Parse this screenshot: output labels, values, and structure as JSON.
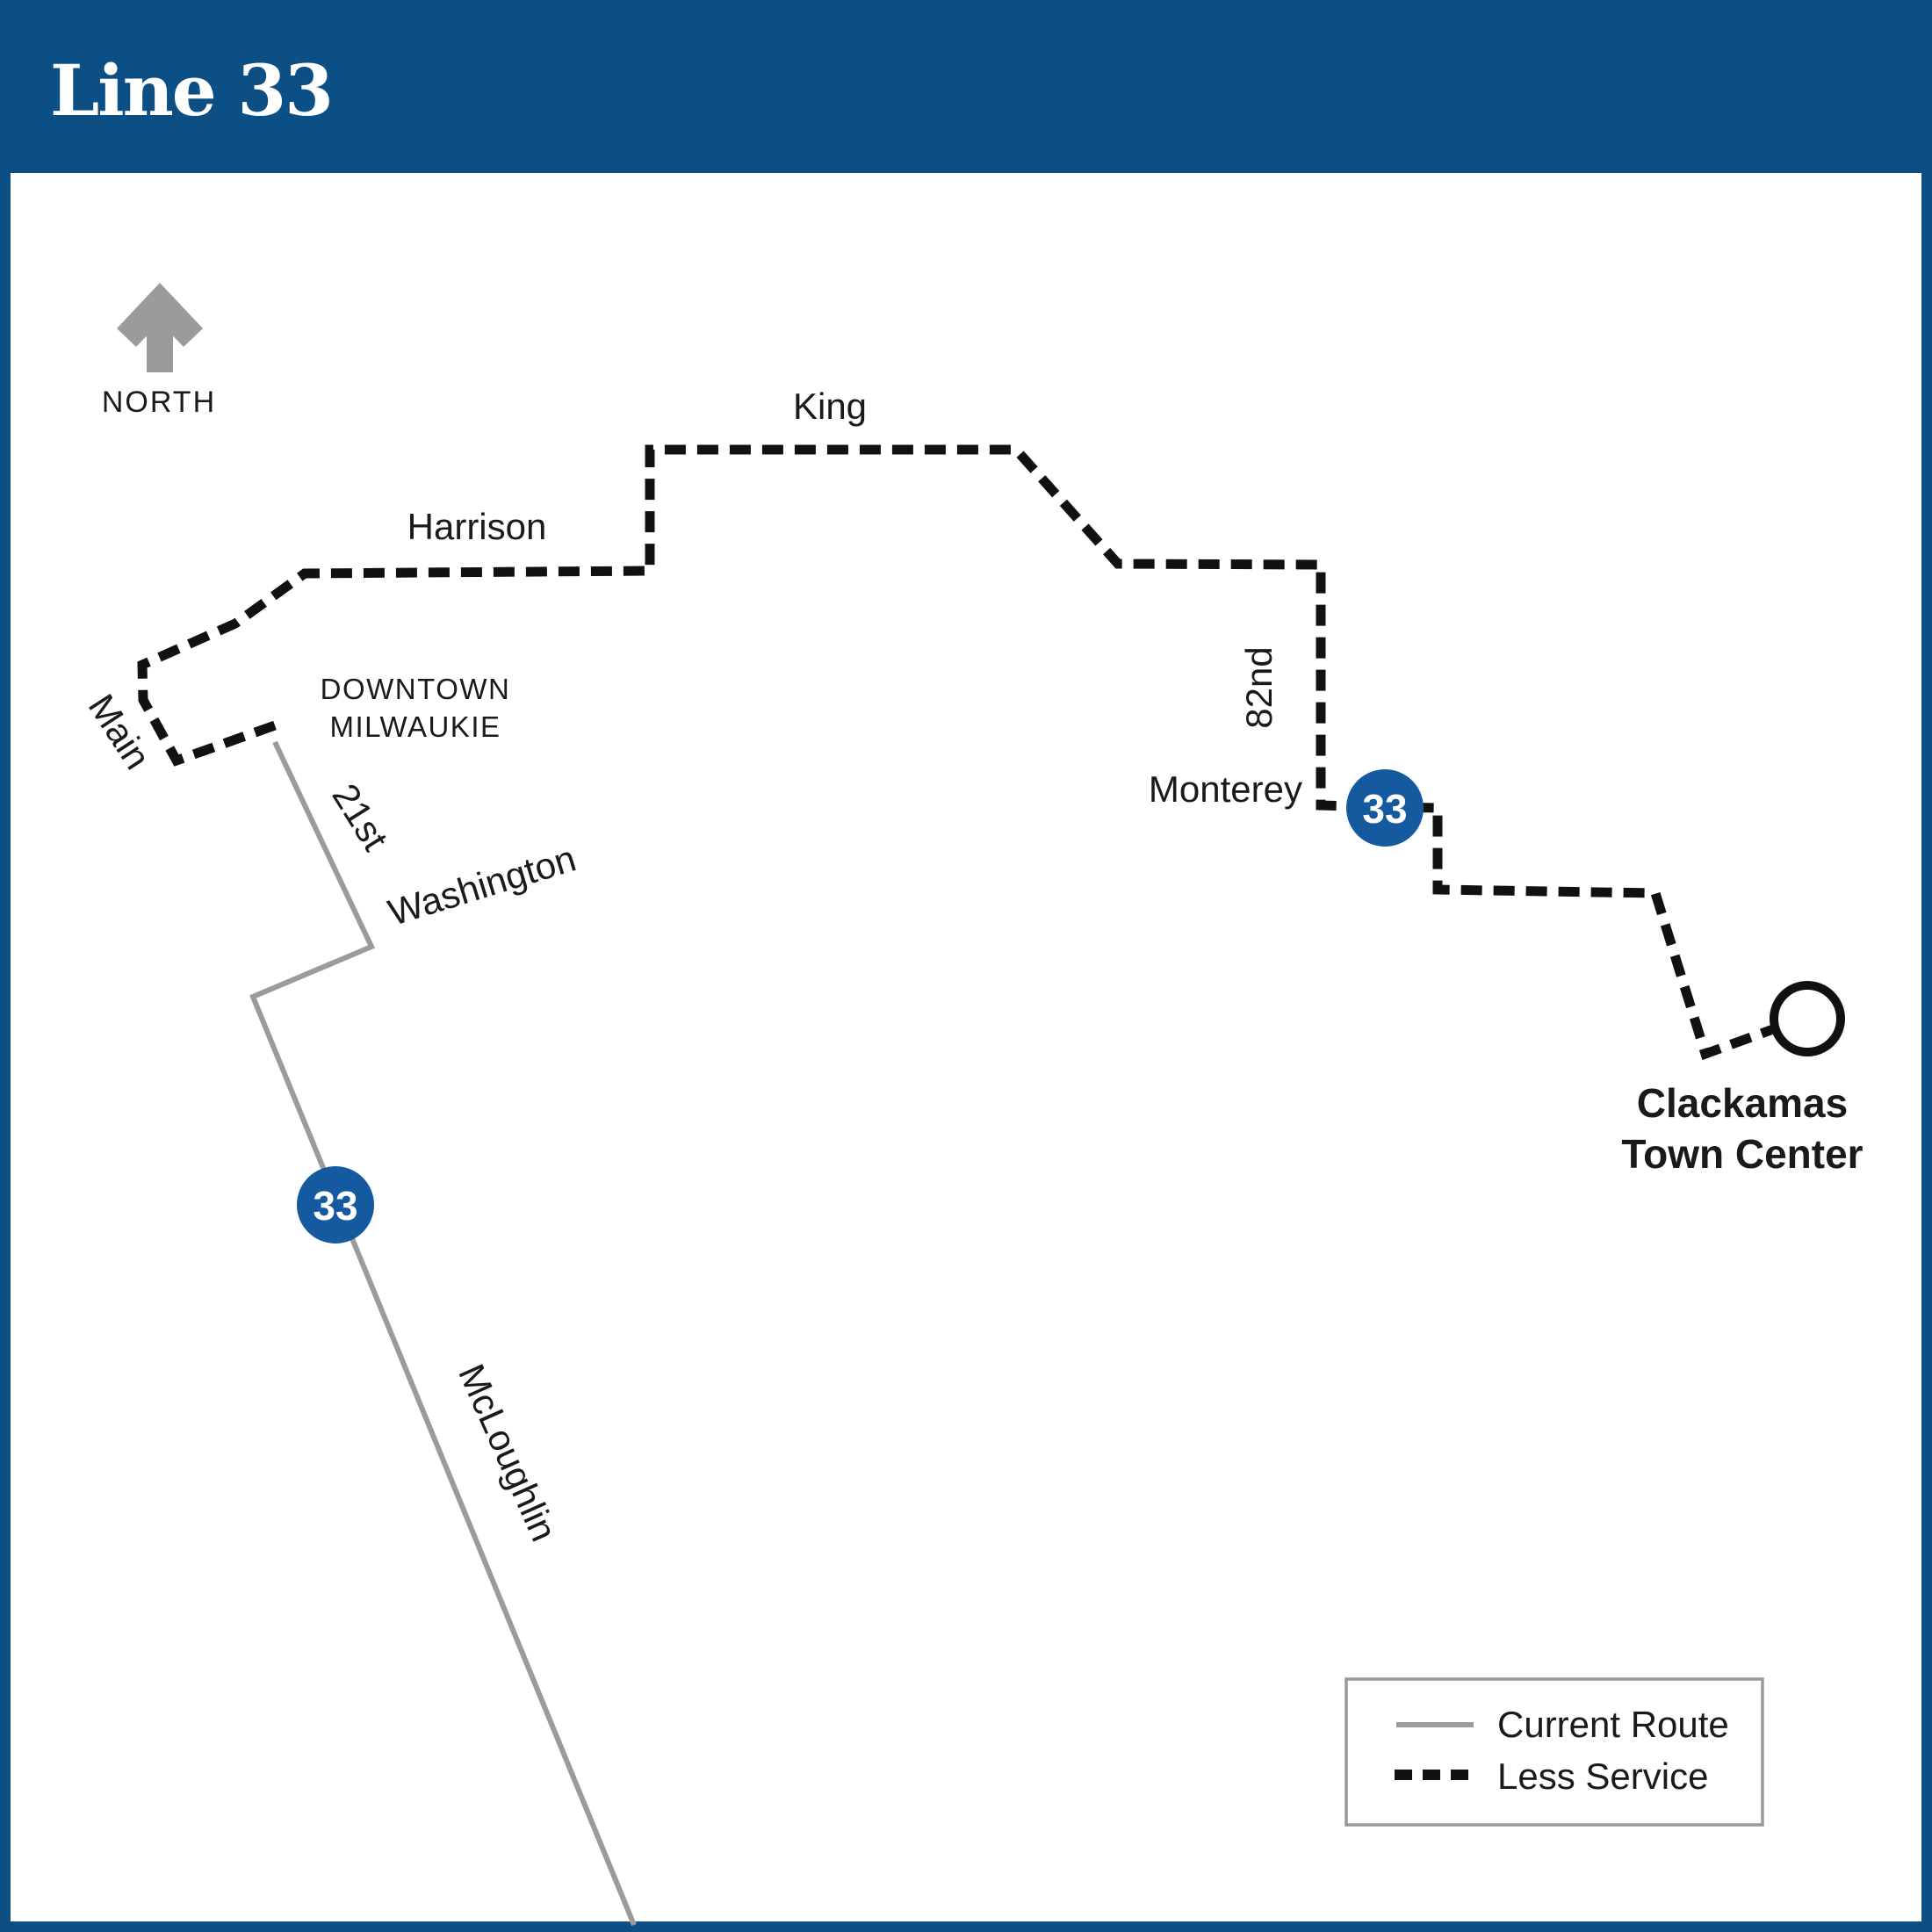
{
  "title": "Line 33",
  "compass": {
    "label": "NORTH"
  },
  "map": {
    "street_labels": {
      "harrison": "Harrison",
      "king": "King",
      "main": "Main",
      "twenty_first": "21st",
      "washington": "Washington",
      "eighty_second": "82nd",
      "monterey": "Monterey",
      "mcloughlin": "McLoughlin"
    },
    "area_label": {
      "line1": "DOWNTOWN",
      "line2": "MILWAUKIE"
    },
    "terminus": {
      "line1": "Clackamas",
      "line2": "Town Center"
    },
    "badge_number": "33",
    "routes": {
      "less_service_points": "313,826 201,866 163,797 162,757 268,710 347,653 740,650 740,512 1157,512 1273,642 1504,643 1504,917 1577,919 1637,920 1637,1013 1885,1017 1942,1200 2019,1172",
      "current_route_points": "313,845 423,1078 288,1135 722,2192"
    }
  },
  "legend": {
    "current_route_label": "Current Route",
    "less_service_label": "Less Service"
  },
  "colors": {
    "header_blue": "#0B4F85",
    "badge_blue": "#15599E",
    "route_gray": "#9B9B9E",
    "dash_black": "#111111",
    "text_dark": "#1A1A1A",
    "legend_border": "#999999",
    "white": "#FFFFFF"
  }
}
